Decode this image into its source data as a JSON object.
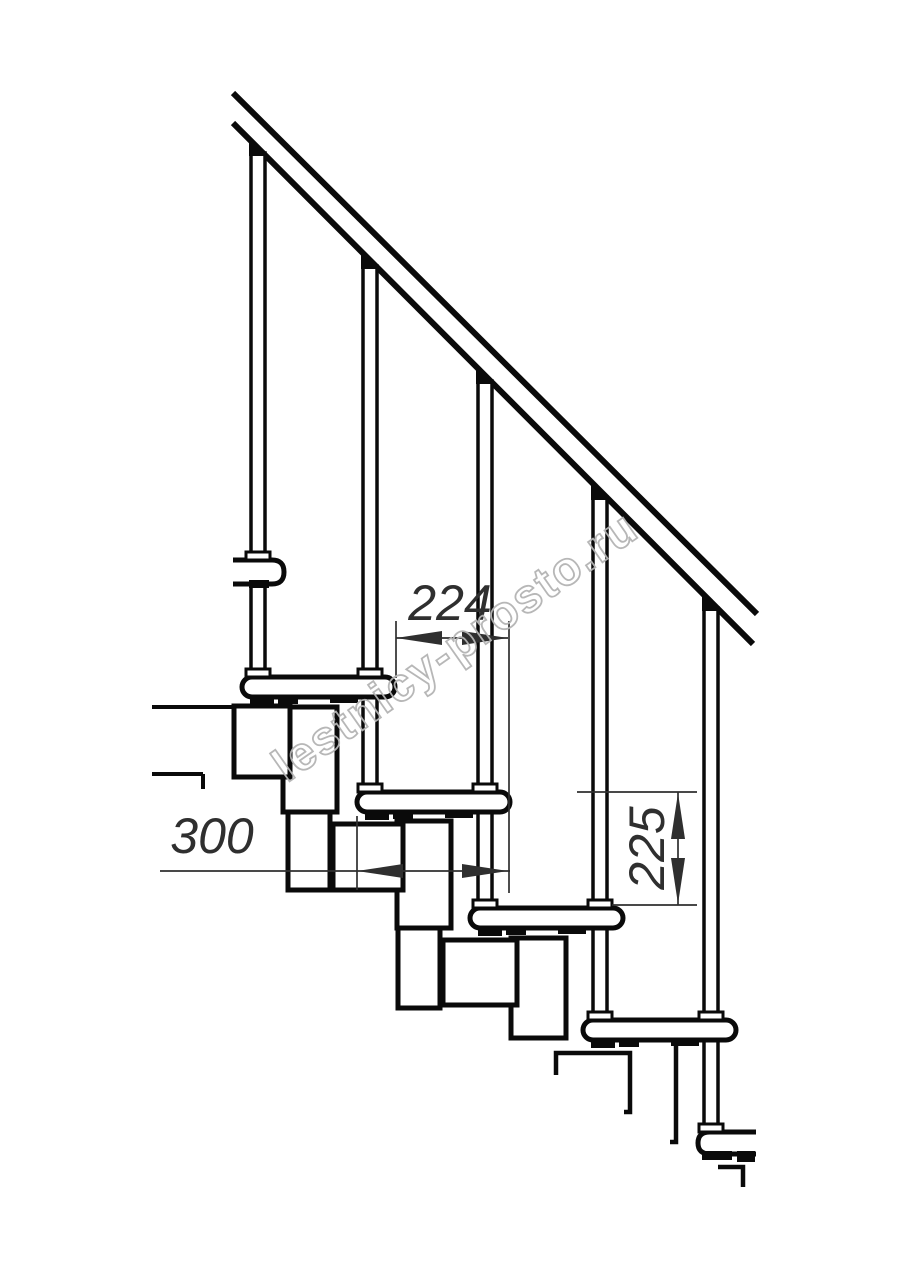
{
  "drawing": {
    "background_color": "#ffffff",
    "line_color": "#0a0a0a",
    "dimension_color": "#2f2f2f",
    "watermark_color": "#b4b4b4",
    "dimensions": {
      "going": "224",
      "tread_depth": "300",
      "rise": "225"
    },
    "watermark": "lestnicy-prosto.ru"
  }
}
